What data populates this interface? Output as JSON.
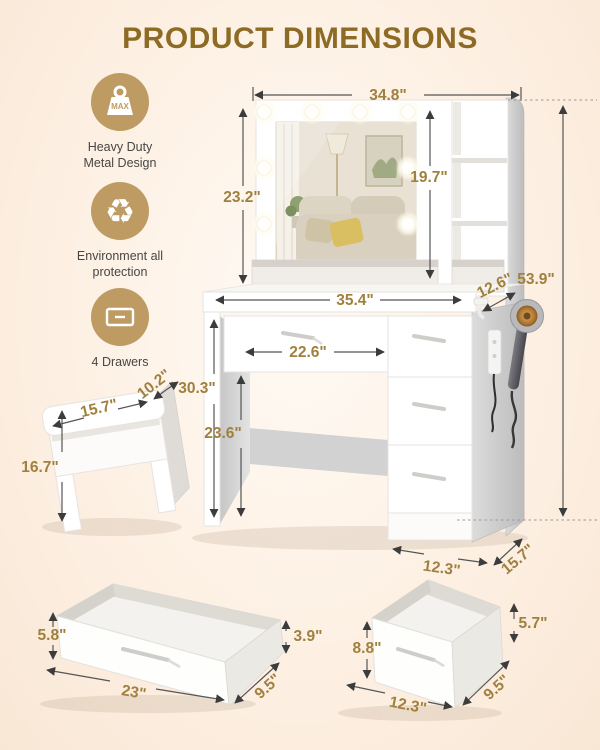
{
  "page": {
    "title": "PRODUCT DIMENSIONS",
    "title_color": "#8d6b25",
    "accent_gold": "#bf9b64",
    "dimension_text_color": "#a0803f",
    "background": "#fdf0e3"
  },
  "features": [
    {
      "icon": "max-weight-icon",
      "badge": "MAX",
      "line1": "Heavy Duty",
      "line2": "Metal Design"
    },
    {
      "icon": "recycle-icon",
      "glyph": "♻",
      "line1": "Environment all",
      "line2": "protection"
    },
    {
      "icon": "drawer-icon",
      "line1": "4 Drawers",
      "line2": ""
    }
  ],
  "dimensions": {
    "vanity": {
      "top_width": "34.8\"",
      "mirror_height": "23.2\"",
      "shelf_height": "19.7\"",
      "total_height": "53.9\"",
      "desktop_width": "35.4\"",
      "top_depth": "12.6\"",
      "knee_width": "22.6\"",
      "desk_height": "30.3\"",
      "knee_height": "23.6\"",
      "cabinet_width": "12.3\"",
      "cabinet_depth": "15.7\""
    },
    "stool": {
      "width": "15.7\"",
      "depth": "10.2\"",
      "height": "16.7\""
    },
    "wide_drawer": {
      "front_height": "5.8\"",
      "back_height": "3.9\"",
      "width": "23\"",
      "depth": "9.5\""
    },
    "deep_drawer": {
      "front_height": "8.8\"",
      "back_height": "5.7\"",
      "width": "12.3\"",
      "depth": "9.5\""
    }
  }
}
